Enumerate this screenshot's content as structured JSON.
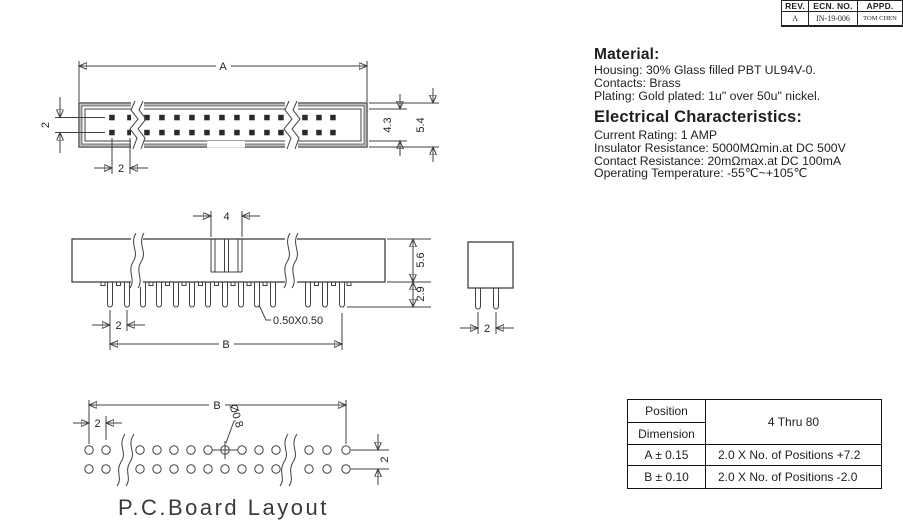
{
  "rev_table": {
    "headers": {
      "rev": "REV.",
      "ecn": "ECN. NO.",
      "appd": "APPD."
    },
    "row": {
      "rev": "A",
      "ecn": "IN-19-006",
      "appd": "TOM CHEN"
    }
  },
  "material": {
    "heading": "Material:",
    "lines": [
      "Housing: 30% Glass filled PBT UL94V-0.",
      "Contacts: Brass",
      "Plating: Gold plated: 1u\" over 50u\" nickel."
    ]
  },
  "electrical": {
    "heading": "Electrical Characteristics:",
    "lines": [
      "Current Rating: 1 AMP",
      "Insulator Resistance: 5000MΩmin.at DC 500V",
      "Contact Resistance: 20mΩmax.at DC 100mA",
      "Operating Temperature: -55℃~+105℃"
    ]
  },
  "top_view": {
    "dim_a": "A",
    "dim_row_pitch": "2",
    "dim_pin_pitch": "2",
    "dim_inner_height": "4.3",
    "dim_outer_height": "5.4"
  },
  "side_view": {
    "dim_slot_width": "4",
    "dim_body_height": "5.6",
    "dim_pin_length": "2.9",
    "dim_pin_pitch": "2",
    "pin_section_label": "0.50X0.50",
    "dim_b": "B"
  },
  "end_view": {
    "dim_pin_pitch": "2"
  },
  "pcb_layout": {
    "dim_b": "B",
    "dim_pin_pitch": "2",
    "hole_dia_label": "Ø0.8",
    "dim_row_pitch": "2",
    "caption": "P.C.Board Layout"
  },
  "spec_table": {
    "corner_top": "Position",
    "corner_bottom": "Dimension",
    "range_header": "4 Thru 80",
    "rows": [
      {
        "dimension": "A ± 0.15",
        "formula": "2.0 X No. of Positions +7.2"
      },
      {
        "dimension": "B ± 0.10",
        "formula": "2.0 X No. of Positions -2.0"
      }
    ]
  }
}
